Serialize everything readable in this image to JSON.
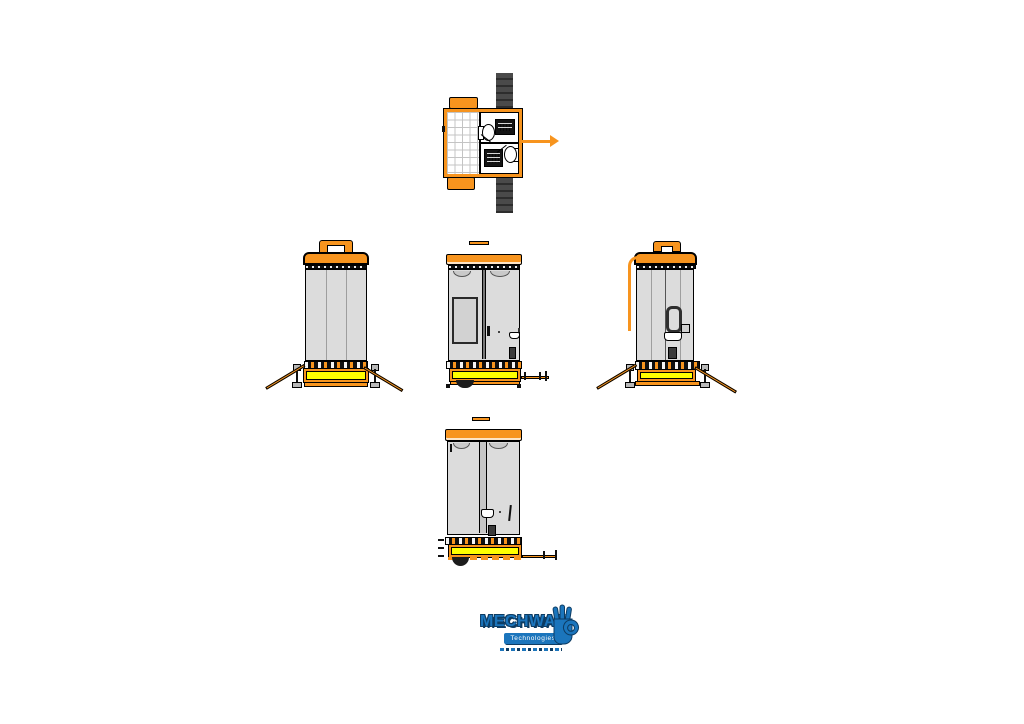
{
  "colors": {
    "orange": "#F7941E",
    "yellow": "#FFFF00",
    "body-gray": "#DCDCDC",
    "panel-line": "#9E9E9E",
    "outline": "#111111",
    "walkway": "#3F3F3F",
    "logo-blue": "#1B75BC",
    "logo-navy": "#0D3C63",
    "background": "#FFFFFF"
  },
  "logo": {
    "brand": "MECHWAT",
    "subtitle": "Technologies"
  }
}
